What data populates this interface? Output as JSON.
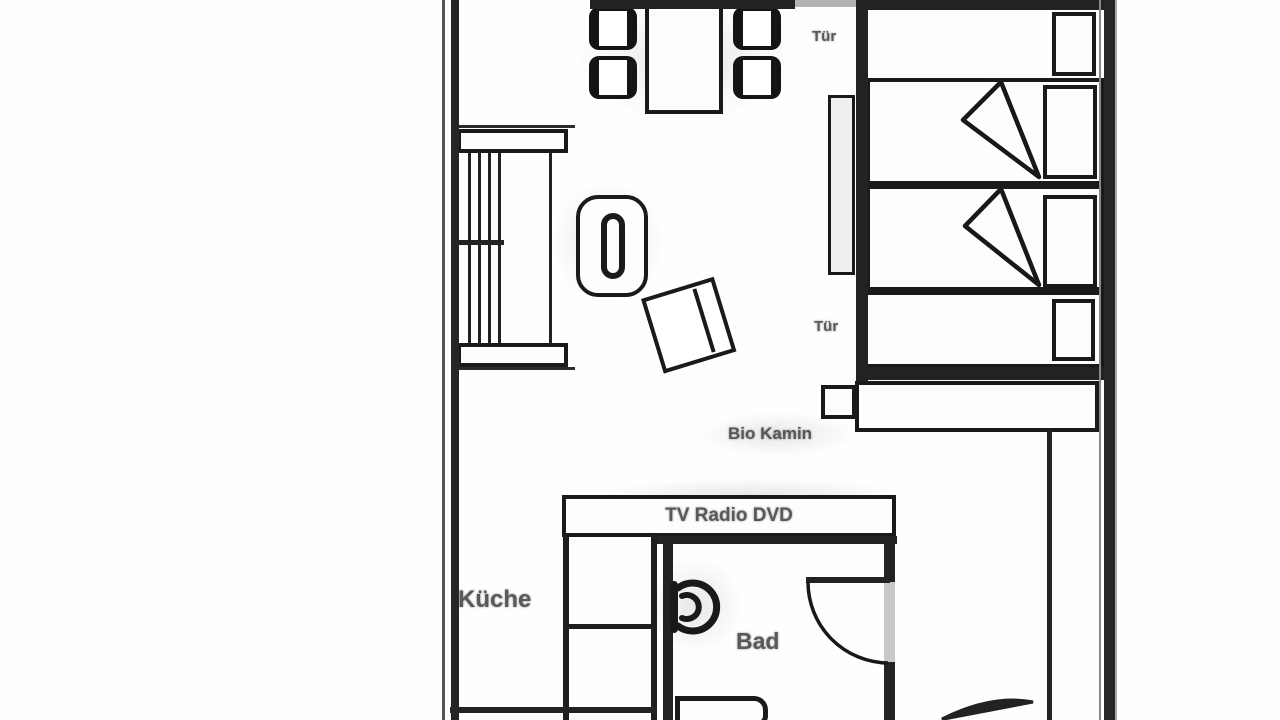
{
  "labels": {
    "door_top": "Tür",
    "door_bedroom": "Tür",
    "fireplace": "Bio Kamin",
    "media_unit": "TV Radio DVD",
    "kitchen": "Küche",
    "bathroom": "Bad"
  },
  "colors": {
    "background": "#ffffff",
    "line": "#1c1c1c",
    "label_text": "#3d3d3d",
    "wall_gap": "#b3b3b3"
  }
}
